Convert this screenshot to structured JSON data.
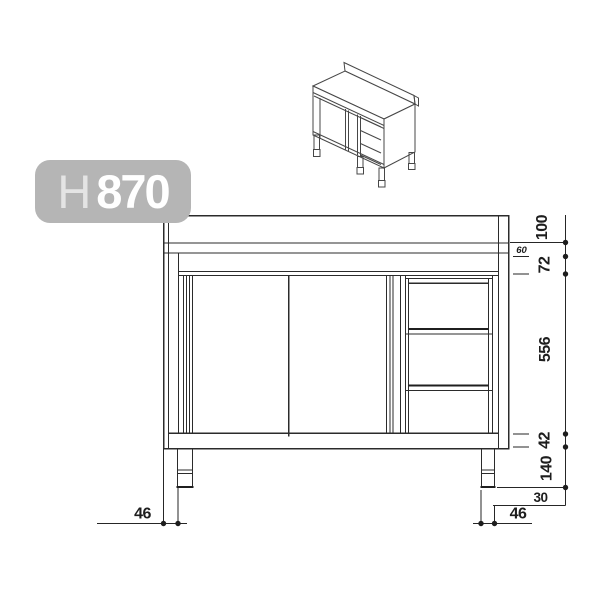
{
  "badge": {
    "prefix": "H",
    "value": "870",
    "bg_color": "#b5b5b5",
    "text_color": "#ffffff"
  },
  "colors": {
    "drawing_line": "#2b2b2b",
    "dimension_line": "#262626",
    "isometric_line": "#474747",
    "background": "#ffffff"
  },
  "views": {
    "isometric": "3d preview of worktable cabinet with sliding doors, three drawers, upstand and legs",
    "front": "front elevation of worktable cabinet with two sliding doors and drawer column"
  },
  "dimensions": {
    "right_chain": [
      {
        "id": "upstand-height",
        "value": "100"
      },
      {
        "id": "worktop-offset",
        "value": "60"
      },
      {
        "id": "top-rail-height",
        "value": "72"
      },
      {
        "id": "door-opening-height",
        "value": "556"
      },
      {
        "id": "base-rail-height",
        "value": "42"
      },
      {
        "id": "leg-height",
        "value": "140"
      }
    ],
    "bottom_right": [
      {
        "id": "foot-offset",
        "value": "30"
      },
      {
        "id": "leg-width",
        "value": "46"
      }
    ],
    "bottom_left": [
      {
        "id": "leg-inset",
        "value": "46"
      }
    ]
  }
}
